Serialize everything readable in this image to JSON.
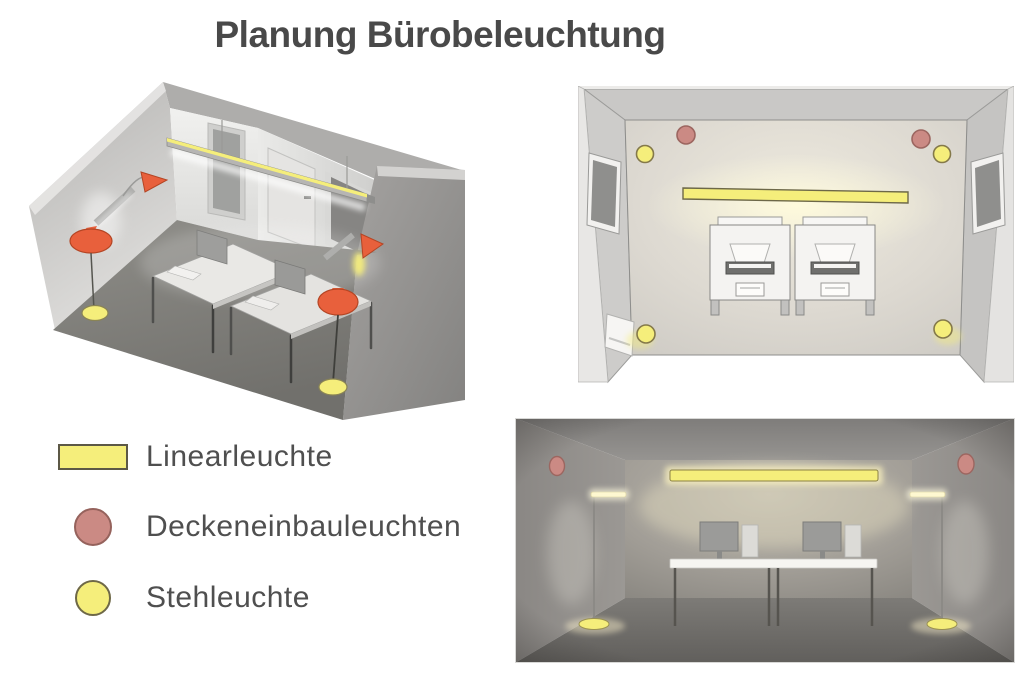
{
  "title": "Planung Bürobeleuchtung",
  "legend": {
    "items": [
      {
        "id": "linearleuchte",
        "label": "Linearleuchte",
        "swatch": "rectangle",
        "color": "#F5EE7B"
      },
      {
        "id": "deckeneinbauleuchten",
        "label": "Deckeneinbauleuchten",
        "swatch": "circle",
        "color": "#CB8A84"
      },
      {
        "id": "stehleuchte",
        "label": "Stehleuchte",
        "swatch": "circle",
        "color": "#F5EE7B"
      }
    ]
  },
  "colors": {
    "background": "#FFFFFF",
    "title_text": "#494949",
    "legend_text": "#4F4F4F",
    "linear_luminaire_yellow": "#F5EE7B",
    "recessed_ceiling_salmon": "#CB8A84",
    "floor_lamp_yellow": "#F5EE7B",
    "annotation_arrow_orange": "#E8603C"
  },
  "views": {
    "isometric": {
      "linear_luminaires": 1,
      "floor_lamps": 2,
      "desks": 2,
      "annotation_arrows": 2
    },
    "plan": {
      "linear_luminaires": 1,
      "ceiling_spots": 2,
      "floor_lamps": 4,
      "desks": 2
    },
    "front": {
      "linear_luminaires": 1,
      "ceiling_spots": 2,
      "floor_lamps": 2,
      "desks": 2
    }
  }
}
